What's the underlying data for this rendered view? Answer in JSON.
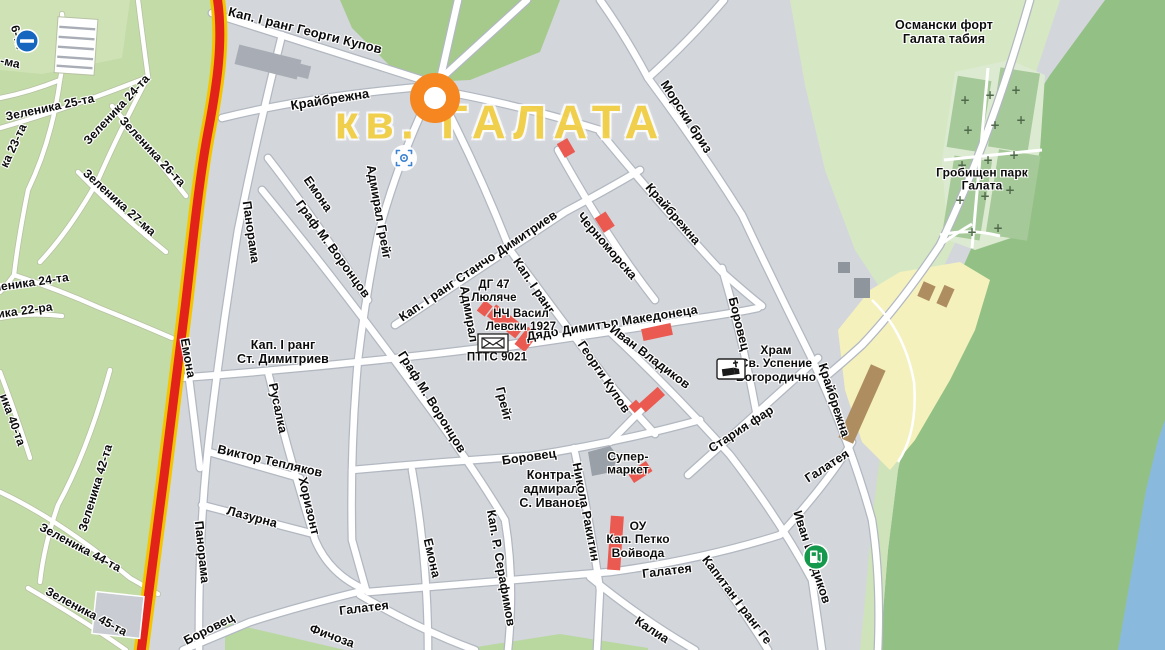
{
  "map": {
    "district_label": {
      "text": "кв. ГАЛАТА",
      "color": "#f2cf45",
      "x": 500,
      "y": 122
    },
    "colors": {
      "urban": "#d3d6db",
      "green_left": "#c3dba7",
      "green_dark": "#a5ca8b",
      "green_fort": "#d6e8c3",
      "green_big": "#93c185",
      "cemetery": "#dcead2",
      "sea": "#89badd",
      "beach": "#f5f1bd",
      "route_red": "#e2231a",
      "route_yellow": "#f3c500",
      "building_red": "#ea5a50",
      "building_brown": "#ae8d61"
    },
    "labels": [
      {
        "t": "Кап. І ранг Георги Купов",
        "x": 305,
        "y": 31,
        "r": 14,
        "s": 13
      },
      {
        "t": "Крайбрежна",
        "x": 330,
        "y": 100,
        "r": -9,
        "s": 13
      },
      {
        "t": "Морски бриз",
        "x": 686,
        "y": 117,
        "r": 57,
        "s": 13
      },
      {
        "t": "Османски форт\nГалата табия",
        "x": 944,
        "y": 32,
        "r": 0,
        "s": 12.5,
        "cls": "place"
      },
      {
        "t": "Гробищен парк\nГалата",
        "x": 982,
        "y": 180,
        "r": 0,
        "s": 12,
        "cls": "place"
      },
      {
        "t": "Зеленика 25-та",
        "x": 50,
        "y": 108,
        "r": -12,
        "s": 12
      },
      {
        "t": "Зеленика 24-та",
        "x": 117,
        "y": 110,
        "r": -47,
        "s": 12
      },
      {
        "t": "Зеленика 26-та",
        "x": 152,
        "y": 152,
        "r": 47,
        "s": 12
      },
      {
        "t": "Зеленика 27-ма",
        "x": 119,
        "y": 203,
        "r": 42,
        "s": 12
      },
      {
        "t": "ка 23-та",
        "x": 14,
        "y": 146,
        "r": -65,
        "s": 12
      },
      {
        "t": "6-та",
        "x": 17,
        "y": 37,
        "r": 75,
        "s": 12
      },
      {
        "t": "-ма",
        "x": 10,
        "y": 63,
        "r": 12,
        "s": 12
      },
      {
        "t": "Зеленика 24-та",
        "x": 24,
        "y": 284,
        "r": -8,
        "s": 12
      },
      {
        "t": "еника 22-ра",
        "x": 18,
        "y": 312,
        "r": -8,
        "s": 12
      },
      {
        "t": "ика 40-та",
        "x": 12,
        "y": 420,
        "r": 70,
        "s": 12
      },
      {
        "t": "Зеленика 42-та",
        "x": 96,
        "y": 488,
        "r": -73,
        "s": 12
      },
      {
        "t": "Зеленика 44-та",
        "x": 80,
        "y": 548,
        "r": 28,
        "s": 12
      },
      {
        "t": "Зеленика 45-та",
        "x": 86,
        "y": 612,
        "r": 28,
        "s": 12
      },
      {
        "t": "Панорама",
        "x": 251,
        "y": 232,
        "r": 82,
        "s": 12.5
      },
      {
        "t": "Панорама",
        "x": 202,
        "y": 552,
        "r": 84,
        "s": 12.5
      },
      {
        "t": "Емона",
        "x": 318,
        "y": 194,
        "r": 55,
        "s": 12.5
      },
      {
        "t": "Емона",
        "x": 188,
        "y": 358,
        "r": 80,
        "s": 12.5
      },
      {
        "t": "Емона",
        "x": 432,
        "y": 558,
        "r": 77,
        "s": 12.5
      },
      {
        "t": "Граф М. Воронцов",
        "x": 333,
        "y": 249,
        "r": 54,
        "s": 12.5
      },
      {
        "t": "Граф М. Воронцов",
        "x": 432,
        "y": 402,
        "r": 58,
        "s": 12.5
      },
      {
        "t": "Кап. І ранг Станчо Димитриев",
        "x": 478,
        "y": 266,
        "r": -34,
        "s": 12.5
      },
      {
        "t": "Адмирал Грейг",
        "x": 379,
        "y": 212,
        "r": 80,
        "s": 12.5
      },
      {
        "t": "Адмирал",
        "x": 469,
        "y": 314,
        "r": 80,
        "s": 12.5
      },
      {
        "t": "Грейг",
        "x": 504,
        "y": 404,
        "r": 76,
        "s": 12.5
      },
      {
        "t": "Кап. І ранг",
        "x": 534,
        "y": 286,
        "r": 56,
        "s": 12.5
      },
      {
        "t": "Георги Купов",
        "x": 604,
        "y": 377,
        "r": 56,
        "s": 12.5
      },
      {
        "t": "Дядо Димитър Македонеца",
        "x": 612,
        "y": 323,
        "r": -9,
        "s": 12.5
      },
      {
        "t": "Черноморска",
        "x": 607,
        "y": 246,
        "r": 49,
        "s": 12.5
      },
      {
        "t": "Крайбрежна",
        "x": 673,
        "y": 214,
        "r": 49,
        "s": 12.5
      },
      {
        "t": "Крайбрежна",
        "x": 834,
        "y": 400,
        "r": 72,
        "s": 12.5
      },
      {
        "t": "Иван Владиков",
        "x": 650,
        "y": 357,
        "r": 37,
        "s": 12.5
      },
      {
        "t": "Иван Владиков",
        "x": 812,
        "y": 557,
        "r": 72,
        "s": 12.5
      },
      {
        "t": "Боровец",
        "x": 739,
        "y": 324,
        "r": 76,
        "s": 12.5
      },
      {
        "t": "Боровец",
        "x": 529,
        "y": 457,
        "r": -8,
        "s": 12.5
      },
      {
        "t": "Боровец",
        "x": 209,
        "y": 629,
        "r": -27,
        "s": 12.5
      },
      {
        "t": "Храм\nСв. Успение\nБогородично",
        "x": 776,
        "y": 364,
        "r": 0,
        "s": 12,
        "cls": "place"
      },
      {
        "t": "Стария фар",
        "x": 741,
        "y": 429,
        "r": -33,
        "s": 12.5
      },
      {
        "t": "Галатея",
        "x": 827,
        "y": 466,
        "r": -33,
        "s": 12.5
      },
      {
        "t": "Галатея",
        "x": 667,
        "y": 571,
        "r": -7,
        "s": 12.5
      },
      {
        "t": "Галатея",
        "x": 364,
        "y": 608,
        "r": -7,
        "s": 12.5
      },
      {
        "t": "Фичоза",
        "x": 332,
        "y": 636,
        "r": 20,
        "s": 12.5
      },
      {
        "t": "Капитан І ранг Ге",
        "x": 737,
        "y": 600,
        "r": 53,
        "s": 12.5
      },
      {
        "t": "Калиа",
        "x": 652,
        "y": 630,
        "r": 33,
        "s": 12.5
      },
      {
        "t": "Виктор Тепляков",
        "x": 270,
        "y": 461,
        "r": 13,
        "s": 12.5
      },
      {
        "t": "Лазурна",
        "x": 252,
        "y": 517,
        "r": 15,
        "s": 12.5
      },
      {
        "t": "Хоризонт",
        "x": 309,
        "y": 506,
        "r": 77,
        "s": 12.5
      },
      {
        "t": "Русалка",
        "x": 278,
        "y": 408,
        "r": 78,
        "s": 12.5
      },
      {
        "t": "Кап. І ранг\nСт. Димитриев",
        "x": 283,
        "y": 352,
        "r": 0,
        "s": 12.5,
        "cls": "place"
      },
      {
        "t": "Кап. Р. Серафимов",
        "x": 501,
        "y": 568,
        "r": 80,
        "s": 12.5
      },
      {
        "t": "Контра-\nадмирал\nС. Иванов",
        "x": 551,
        "y": 489,
        "r": 0,
        "s": 12.5,
        "cls": "place"
      },
      {
        "t": "Никола Ракитин",
        "x": 586,
        "y": 512,
        "r": 79,
        "s": 12.5
      },
      {
        "t": "Супер-\nмаркет",
        "x": 628,
        "y": 464,
        "r": 0,
        "s": 12,
        "cls": "place"
      },
      {
        "t": "ОУ\nКап. Петко\nВойвода",
        "x": 638,
        "y": 540,
        "r": 0,
        "s": 12,
        "cls": "place"
      },
      {
        "t": "ДГ 47\nЛюляче",
        "x": 494,
        "y": 292,
        "r": 0,
        "s": 11.5,
        "cls": "place"
      },
      {
        "t": "НЧ Васил\nЛевски 1927",
        "x": 521,
        "y": 321,
        "r": 0,
        "s": 11.5,
        "cls": "place"
      },
      {
        "t": "ПТТС 9021",
        "x": 497,
        "y": 358,
        "r": 0,
        "s": 11.5,
        "cls": "place"
      }
    ],
    "pois": [
      {
        "type": "route-marker",
        "name": "route-marker-icon",
        "x": 435,
        "y": 98
      },
      {
        "type": "camera",
        "name": "street-view-camera-icon",
        "x": 404,
        "y": 158
      },
      {
        "type": "no-entry",
        "name": "no-entry-sign-icon",
        "x": 27,
        "y": 41
      },
      {
        "type": "church",
        "name": "church-icon",
        "x": 731,
        "y": 369
      },
      {
        "type": "post",
        "name": "post-office-icon",
        "x": 493,
        "y": 343
      },
      {
        "type": "fuel",
        "name": "ev-charging-station-icon",
        "x": 816,
        "y": 557
      }
    ]
  }
}
